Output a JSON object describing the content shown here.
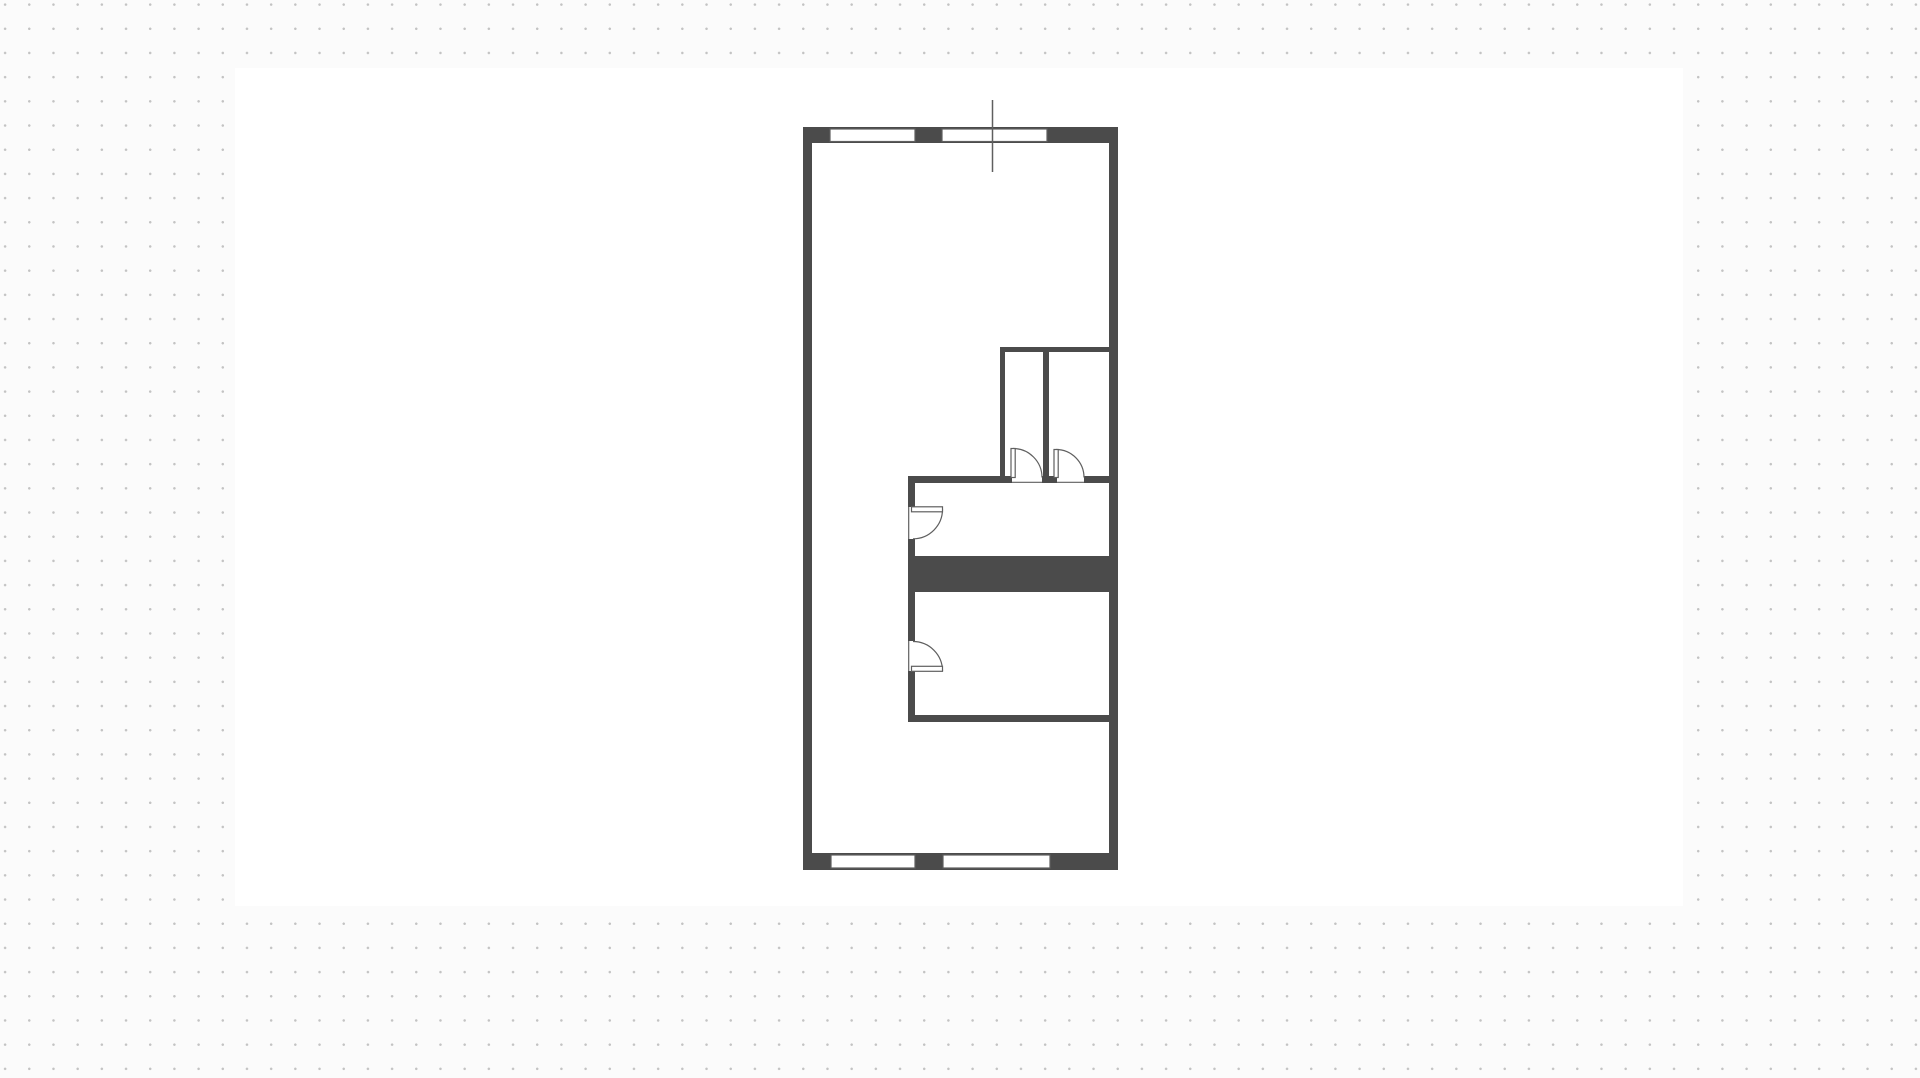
{
  "app": {
    "background_color": "#fbfbfb"
  },
  "grid": {
    "dot_color": "#c3c3c3",
    "dot_radius_px": 1.15,
    "spacing_px": 24.2,
    "offset_x": -7,
    "offset_y": -7.5
  },
  "artboard": {
    "x": 235,
    "y": 68,
    "width": 1448,
    "height": 838,
    "color": "#ffffff"
  },
  "floor_plan": {
    "wall_color": "#4b4b4b",
    "line_color": "#5f5f5f",
    "fill_color": "#ffffff",
    "line_width": 1.2,
    "walls": [
      {
        "name": "exterior-top-wall",
        "x": 803,
        "y": 127,
        "w": 315,
        "h": 16
      },
      {
        "name": "exterior-bottom-wall",
        "x": 803,
        "y": 853,
        "w": 315,
        "h": 17
      },
      {
        "name": "exterior-left-wall",
        "x": 803,
        "y": 127,
        "w": 9,
        "h": 743
      },
      {
        "name": "exterior-right-wall",
        "x": 1109,
        "y": 127,
        "w": 9,
        "h": 743
      },
      {
        "name": "closet-top-wall",
        "x": 1000,
        "y": 347,
        "w": 109,
        "h": 5
      },
      {
        "name": "closet-left-wall",
        "x": 1000,
        "y": 347,
        "w": 5,
        "h": 136
      },
      {
        "name": "closet-divider-wall",
        "x": 1043,
        "y": 352,
        "w": 6,
        "h": 131
      },
      {
        "name": "hall-top-wall-left",
        "x": 908,
        "y": 476,
        "w": 104,
        "h": 7
      },
      {
        "name": "hall-top-wall-mid",
        "x": 1042,
        "y": 476,
        "w": 15,
        "h": 7
      },
      {
        "name": "hall-top-wall-right",
        "x": 1084,
        "y": 476,
        "w": 25,
        "h": 7
      },
      {
        "name": "interior-left-wall-a",
        "x": 908,
        "y": 483,
        "w": 7,
        "h": 24
      },
      {
        "name": "interior-left-wall-b",
        "x": 908,
        "y": 539,
        "w": 7,
        "h": 17
      },
      {
        "name": "stair-block",
        "x": 908,
        "y": 556,
        "w": 202,
        "h": 36
      },
      {
        "name": "interior-left-wall-c",
        "x": 908,
        "y": 592,
        "w": 7,
        "h": 49
      },
      {
        "name": "interior-left-wall-d",
        "x": 908,
        "y": 671,
        "w": 7,
        "h": 44
      },
      {
        "name": "lower-room-bottom-wall",
        "x": 908,
        "y": 715,
        "w": 202,
        "h": 7
      }
    ],
    "windows": [
      {
        "name": "window-top-left",
        "x": 830,
        "y": 129,
        "w": 85,
        "h": 12.5
      },
      {
        "name": "window-top-right",
        "x": 942,
        "y": 129,
        "w": 105,
        "h": 12.5
      },
      {
        "name": "window-bottom-left",
        "x": 831,
        "y": 855,
        "w": 84,
        "h": 13
      },
      {
        "name": "window-bottom-right",
        "x": 943,
        "y": 855,
        "w": 107,
        "h": 13
      }
    ],
    "door_openings": [
      {
        "name": "closet-left-doorway",
        "x": 1012,
        "y": 475.5,
        "w": 30,
        "h": 8,
        "edge": "bottom"
      },
      {
        "name": "closet-right-doorway",
        "x": 1057,
        "y": 475.5,
        "w": 27,
        "h": 8,
        "edge": "bottom"
      },
      {
        "name": "hall-doorway",
        "x": 907.5,
        "y": 507,
        "w": 8,
        "h": 32,
        "edge": "left"
      },
      {
        "name": "lower-room-doorway",
        "x": 907.5,
        "y": 641,
        "w": 8,
        "h": 30,
        "edge": "left"
      }
    ],
    "doors": [
      {
        "name": "closet-left-door",
        "leaf": {
          "x": 1011,
          "y": 448.5,
          "w": 4.2,
          "h": 29
        },
        "arc": "M 1013,448.5 A 29,29 0 0 1 1042,477.5"
      },
      {
        "name": "closet-right-door",
        "leaf": {
          "x": 1054,
          "y": 449.5,
          "w": 4.2,
          "h": 28
        },
        "arc": "M 1056,449.5 A 28,28 0 0 1 1084,477.5"
      },
      {
        "name": "hall-door",
        "leaf": {
          "x": 911.5,
          "y": 506.8,
          "w": 31,
          "h": 5
        },
        "arc": "M 942.5,509.3 A 29.5,29.5 0 0 1 913,538.8"
      },
      {
        "name": "lower-room-door",
        "leaf": {
          "x": 911.5,
          "y": 666.3,
          "w": 31,
          "h": 5
        },
        "arc": "M 942.5,671 A 29.5,29.5 0 0 0 913,641.5"
      }
    ],
    "reference_line": {
      "name": "reference-line",
      "x": 992.5,
      "y1": 100,
      "y2": 172
    }
  }
}
